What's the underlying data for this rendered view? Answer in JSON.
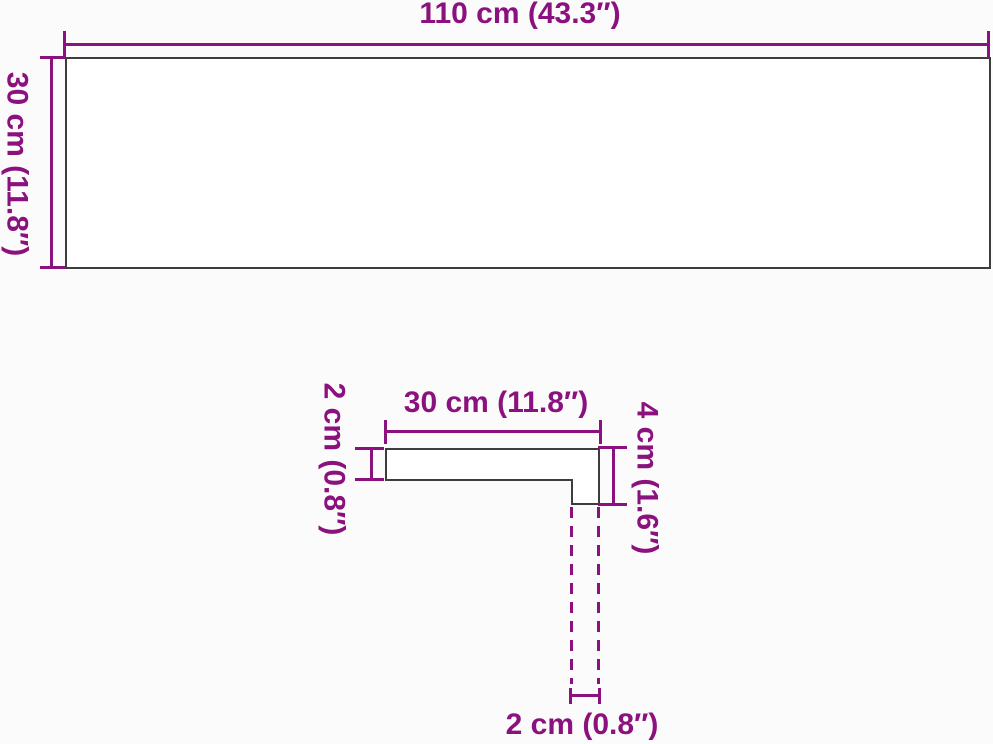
{
  "colors": {
    "accent": "#8B117E",
    "outline": "#3D3D3D",
    "background": "#FBFBFB"
  },
  "figures": {
    "board": {
      "width_label": "110 cm (43.3″)",
      "height_label": "30 cm (11.8″)"
    },
    "profile": {
      "top_width_label": "30 cm (11.8″)",
      "left_thickness_label": "2 cm (0.8″)",
      "right_height_label": "4 cm (1.6″)",
      "bottom_thickness_label": "2 cm (0.8″)"
    }
  }
}
